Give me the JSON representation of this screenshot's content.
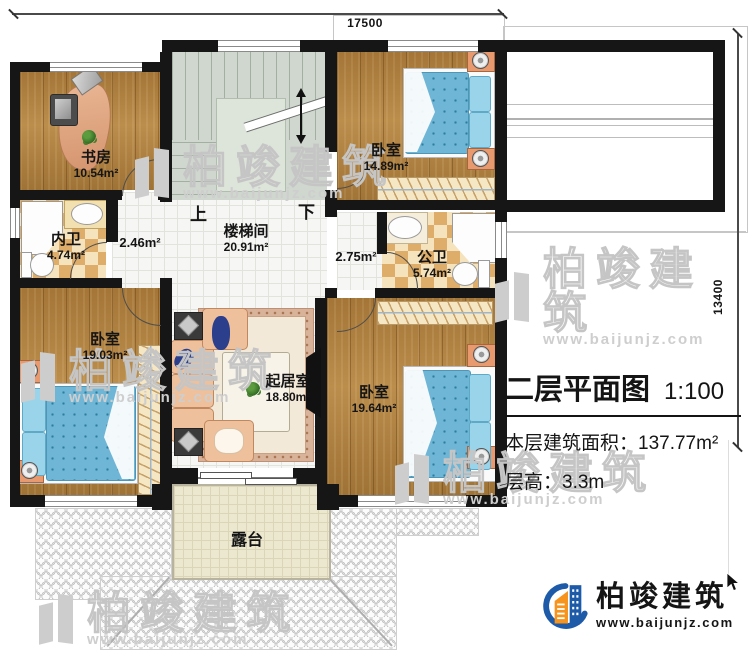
{
  "title_block": {
    "title": "二层平面图",
    "scale": "1:100",
    "area_label": "本层建筑面积：",
    "area_value": "137.77m²",
    "height_label": "层高：",
    "height_value": "3.3m"
  },
  "dimensions": {
    "total_width": "17500",
    "total_height": "13400"
  },
  "rooms": {
    "study": {
      "name": "书房",
      "area": "10.54m²"
    },
    "inner_bath": {
      "name": "内卫",
      "area": "4.74m²"
    },
    "hall_left": {
      "area": "2.46m²"
    },
    "stairwell": {
      "name": "楼梯间",
      "area": "20.91m²",
      "up_label": "上",
      "down_label": "下"
    },
    "hall_right": {
      "area": "2.75m²"
    },
    "bedroom_top": {
      "name": "卧室",
      "area": "14.89m²"
    },
    "public_bath": {
      "name": "公卫",
      "area": "5.74m²"
    },
    "bedroom_left": {
      "name": "卧室",
      "area": "19.03m²"
    },
    "living_room": {
      "name": "起居室",
      "area": "18.80m²"
    },
    "bedroom_bottom_right": {
      "name": "卧室",
      "area": "19.64m²"
    },
    "terrace": {
      "name": "露台"
    }
  },
  "branding": {
    "company": "柏竣建筑",
    "website": "www.baijunjz.com"
  },
  "colors": {
    "wall": "#161616",
    "wood_floor": "#b0813f",
    "bath_tile": "#ddad69",
    "stair": "#cfd7ce",
    "terrace": "#ece7cf",
    "bed_blue": "#6fb6d6",
    "logo_blue": "#1d5aa8",
    "logo_orange": "#f7941d"
  }
}
